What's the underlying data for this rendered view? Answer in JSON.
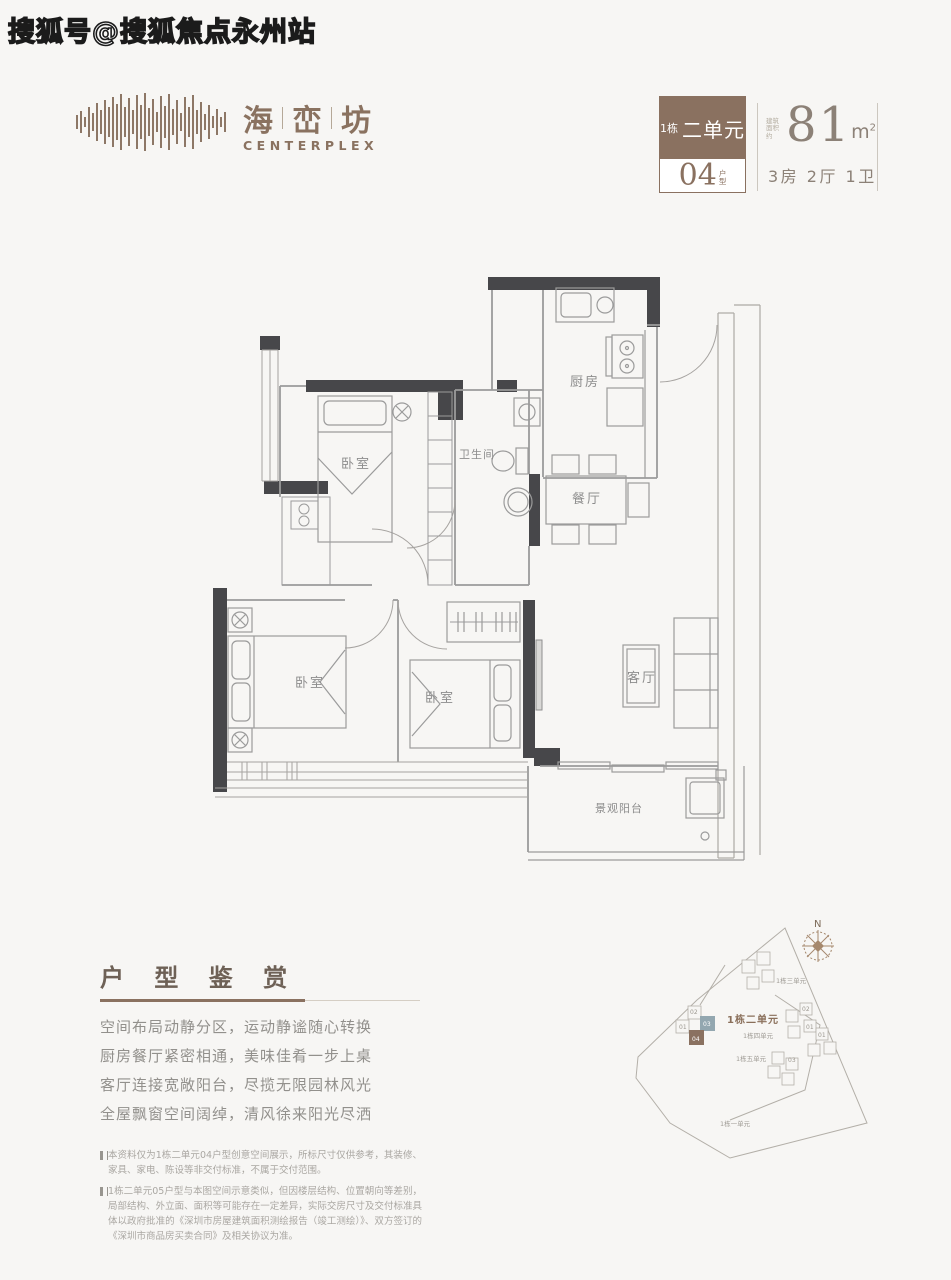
{
  "watermark": "搜狐号@搜狐焦点永州站",
  "brand": {
    "name_1": "海",
    "name_2": "峦",
    "name_3": "坊",
    "subtitle": "CENTERPLEX"
  },
  "badge": {
    "block": "1栋",
    "unit": "二单元",
    "type_number": "04",
    "type_suffix_1": "户",
    "type_suffix_2": "型"
  },
  "area": {
    "prefix_1": "建筑",
    "prefix_2": "面积约",
    "value": "81",
    "unit": "m",
    "sup": "2",
    "rooms": "3房 2厅 1卫"
  },
  "plan": {
    "kitchen": "厨房",
    "bathroom": "卫生间",
    "dining": "餐厅",
    "bedroom": "卧室",
    "living": "客厅",
    "balcony": "景观阳台"
  },
  "appreciation": {
    "title": "户 型 鉴 赏",
    "lines": [
      "空间布局动静分区，运动静谧随心转换",
      "厨房餐厅紧密相通，美味佳肴一步上桌",
      "客厅连接宽敞阳台，尽揽无限园林风光",
      "全屋飘窗空间阔绰，清风徐来阳光尽洒"
    ]
  },
  "notes": [
    "本资料仅为1栋二单元04户型创意空间展示，所标尺寸仅供参考，其装修、家具、家电、陈设等非交付标准，不属于交付范围。",
    "1栋二单元05户型与本图空间示意类似，但因楼层结构、位置朝向等差别，局部结构、外立面、面积等可能存在一定差异，实际交房尺寸及交付标准具体以政府批准的《深圳市房屋建筑面积测绘报告（竣工测绘）》、双方签订的《深圳市商品房买卖合同》及相关协议为准。"
  ],
  "sitemap": {
    "north": "N",
    "highlight_label": "1栋二单元",
    "unit_labels": {
      "one": "1栋一单元",
      "three": "1栋三单元",
      "four": "1栋四单元",
      "five": "1栋五单元"
    },
    "unit_numbers": {
      "n01": "01",
      "n02": "02",
      "n03": "03",
      "n04": "04"
    }
  },
  "colors": {
    "accent_brown": "#8a7160",
    "wall_dark": "#47474a",
    "highlight_blue": "#93a7b0",
    "text_gray": "#92908c"
  }
}
